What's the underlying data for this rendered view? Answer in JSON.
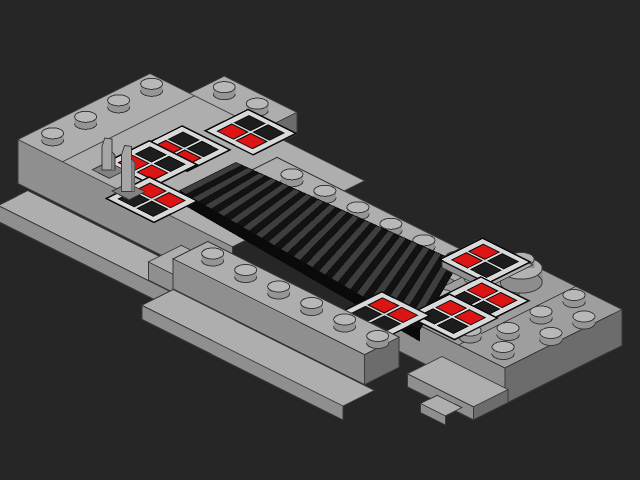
{
  "scene": {
    "description": "Flat-shaded isometric 3D render of a light-gray LEGO bridge model: two stud-covered platforms joined by a black ribbed grille ramp, decorated with eight red-and-black printed console tiles, two small levers and a round brick, on a plain dark background.",
    "canvas": {
      "width": 640,
      "height": 480
    },
    "background": "#262626",
    "iso": {
      "ux": 33,
      "uy": 16.5,
      "uz": 11,
      "ox": 150,
      "oy": 139.5
    },
    "palette": {
      "outline": "#3a3a3a",
      "topA": "#aeaeae",
      "topB": "#9e9e9e",
      "faceFront": "#8f8f8f",
      "faceLeft": "#7b7b7b",
      "faceRight": "#6c6c6c",
      "studTop": "#b8b8b8",
      "studSide": "#959595",
      "studTopDark": "#858585",
      "studSideDark": "#6a6a6a",
      "grilleBase": "#121212",
      "grilleRib": "#3e3e3e",
      "grilleEdge": "#0a0a0a",
      "tileBorder": "#d9d9d9",
      "tileStroke": "#0e0e0e",
      "buttonRed": "#dc1414",
      "buttonBlack": "#1d1d1d",
      "roundTop": "#b2b2b2",
      "roundSide": "#8d8d8d",
      "leverFill": "#a6a6a6",
      "leverShade": "#828282"
    },
    "elements": [
      {
        "type": "box",
        "name": "back-block",
        "x": 1.2,
        "y": -1.05,
        "w": 2.2,
        "d": 1.1,
        "z": 6,
        "fh": 22,
        "faces": "TLFR"
      },
      {
        "type": "studs",
        "name": "back-block-studs",
        "z": 6,
        "shade": "normal",
        "points": [
          [
            1.75,
            -0.5
          ],
          [
            2.75,
            -0.5
          ]
        ]
      },
      {
        "type": "box",
        "name": "left-platform",
        "x": 0,
        "y": 0,
        "w": 6.5,
        "d": 4,
        "z": 6,
        "fh": 44,
        "faces": "TLF"
      },
      {
        "type": "seam",
        "name": "left-platform-seam",
        "from": [
          1.35,
          0,
          6
        ],
        "to": [
          1.35,
          4,
          6
        ]
      },
      {
        "type": "studs",
        "name": "left-edge-studs",
        "z": 6,
        "shade": "normal",
        "points": [
          [
            0.55,
            0.5
          ],
          [
            0.55,
            1.5
          ],
          [
            0.55,
            2.5
          ],
          [
            0.55,
            3.5
          ]
        ]
      },
      {
        "type": "box",
        "name": "left-base",
        "x": 0.3,
        "y": 4.0,
        "w": 5.2,
        "d": 0.9,
        "z": 1.8,
        "fh": 16,
        "faces": "TLF"
      },
      {
        "type": "tile",
        "name": "console-tile-l3",
        "cx": 3.3,
        "cy": 0.25,
        "z": 6,
        "w": 1.45,
        "d": 1.3,
        "buttons": [
          "k",
          "k",
          "r",
          "r"
        ]
      },
      {
        "type": "tile",
        "name": "console-tile-l1",
        "cx": 2.8,
        "cy": 1.75,
        "z": 6,
        "w": 1.45,
        "d": 1.3,
        "buttons": [
          "k",
          "k",
          "r",
          "r"
        ]
      },
      {
        "type": "box",
        "name": "back-rail",
        "x": 3.8,
        "y": -0.05,
        "w": 6.9,
        "d": 1.05,
        "z": 4,
        "fh": 14,
        "faces": "TLFR"
      },
      {
        "type": "studs",
        "name": "back-rail-studs",
        "z": 4,
        "shade": "normal",
        "points": [
          [
            4.75,
            0.45
          ],
          [
            5.75,
            0.45
          ],
          [
            6.75,
            0.45
          ],
          [
            7.75,
            0.45
          ],
          [
            8.75,
            0.45
          ]
        ]
      },
      {
        "type": "studs",
        "name": "back-rail-end-stud",
        "z": 4,
        "shade": "dark",
        "points": [
          [
            9.75,
            0.45
          ]
        ]
      },
      {
        "type": "box",
        "name": "right-platform",
        "x": 9.9,
        "y": -1.0,
        "w": 3.4,
        "d": 3.55,
        "z": 3,
        "fh": 36,
        "faces": "TLFR",
        "top": "topB"
      },
      {
        "type": "seam",
        "name": "right-platform-seam",
        "from": [
          11.9,
          -1.0,
          3
        ],
        "to": [
          11.9,
          2.55,
          3
        ]
      },
      {
        "type": "studs",
        "name": "right-platform-studs",
        "z": 3,
        "shade": "normal",
        "points": [
          [
            10.35,
            -0.5
          ],
          [
            12.35,
            -0.5
          ],
          [
            10.35,
            0.5
          ],
          [
            12.35,
            0.5
          ],
          [
            10.35,
            1.5
          ],
          [
            11.35,
            1.5
          ],
          [
            12.35,
            1.5
          ],
          [
            13.15,
            0.0
          ],
          [
            13.15,
            1.0
          ],
          [
            10.85,
            2.15
          ],
          [
            11.85,
            2.15
          ],
          [
            12.85,
            2.15
          ]
        ]
      },
      {
        "type": "studs",
        "name": "right-platform-shadow-stud",
        "z": 3,
        "shade": "dark",
        "points": [
          [
            11.35,
            0.5
          ]
        ]
      },
      {
        "type": "round",
        "name": "round-brick",
        "cx": 10.95,
        "cy": -0.3,
        "z": 3,
        "r1": 21,
        "r2": 13,
        "h1": 14,
        "h2": 9
      },
      {
        "type": "grille",
        "name": "grille-ramp",
        "ribs": 19,
        "bl": [
          4.0,
          1.4,
          6
        ],
        "br": [
          9.6,
          0.25,
          3.6
        ],
        "fr": [
          11.05,
          2.87,
          3.6
        ],
        "fl": [
          4.0,
          3.1,
          6
        ]
      },
      {
        "type": "tile",
        "name": "console-tile-l2",
        "cx": 2.75,
        "cy": 2.7,
        "z": 6,
        "w": 1.45,
        "d": 1.3,
        "buttons": [
          "k",
          "k",
          "r",
          "r"
        ]
      },
      {
        "type": "tile",
        "name": "console-tile-l4",
        "cx": 3.85,
        "cy": 3.8,
        "z": 6,
        "w": 1.45,
        "d": 1.3,
        "buttons": [
          "r",
          "r",
          "k",
          "k"
        ]
      },
      {
        "type": "lever",
        "name": "lever-1",
        "cx": 2.3,
        "cy": 3.55,
        "z": 6,
        "h": 32
      },
      {
        "type": "lever",
        "name": "lever-2",
        "cx": 3.25,
        "cy": 3.9,
        "z": 6,
        "h": 46
      },
      {
        "type": "box",
        "name": "r1-base",
        "x": 9.2,
        "y": -0.8,
        "w": 1.6,
        "d": 1.15,
        "z": 3.6,
        "fh": 10,
        "faces": "TLF"
      },
      {
        "type": "tile",
        "name": "console-tile-r1",
        "cx": 9.95,
        "cy": -0.2,
        "z": 3.6,
        "w": 1.45,
        "d": 1.3,
        "buttons": [
          "r",
          "k",
          "r",
          "k"
        ]
      },
      {
        "type": "tile",
        "name": "console-tile-r2",
        "cx": 11.05,
        "cy": 0.95,
        "z": 3.45,
        "w": 1.45,
        "d": 1.3,
        "buttons": [
          "r",
          "r",
          "k",
          "k"
        ]
      },
      {
        "type": "tile",
        "name": "console-tile-r3",
        "cx": 11.1,
        "cy": 1.95,
        "z": 3.45,
        "w": 1.45,
        "d": 1.3,
        "buttons": [
          "r",
          "r",
          "k",
          "k"
        ]
      },
      {
        "type": "tile",
        "name": "console-tile-r4",
        "cx": 10.0,
        "cy": 2.9,
        "z": 3.45,
        "w": 1.45,
        "d": 1.3,
        "buttons": [
          "r",
          "r",
          "k",
          "k"
        ]
      },
      {
        "type": "box",
        "name": "front-rail-left-step",
        "x": 4.55,
        "y": 3.6,
        "w": 0.8,
        "d": 1.0,
        "z": 2.6,
        "fh": 18,
        "faces": "TLF"
      },
      {
        "type": "box",
        "name": "front-rail",
        "x": 5.3,
        "y": 3.55,
        "w": 5.8,
        "d": 1.05,
        "z": 4,
        "fh": 30,
        "faces": "TLFR"
      },
      {
        "type": "studs",
        "name": "front-rail-studs",
        "z": 4,
        "shade": "normal",
        "points": [
          [
            5.95,
            4.05
          ],
          [
            6.95,
            4.05
          ],
          [
            7.95,
            4.05
          ],
          [
            8.95,
            4.05
          ],
          [
            9.95,
            4.05
          ],
          [
            10.95,
            4.05
          ]
        ]
      },
      {
        "type": "box",
        "name": "front-apron",
        "x": 5.3,
        "y": 4.6,
        "w": 6.1,
        "d": 0.95,
        "z": 1.2,
        "fh": 14,
        "faces": "TLF"
      },
      {
        "type": "box",
        "name": "right-apron",
        "x": 11.4,
        "y": 2.55,
        "w": 2.0,
        "d": 1.05,
        "z": 1.2,
        "fh": 13,
        "faces": "TLFR"
      },
      {
        "type": "box",
        "name": "notch-step",
        "x": 12.3,
        "y": 3.6,
        "w": 0.75,
        "d": 0.5,
        "z": 0.6,
        "fh": 9,
        "faces": "TLF"
      }
    ]
  }
}
